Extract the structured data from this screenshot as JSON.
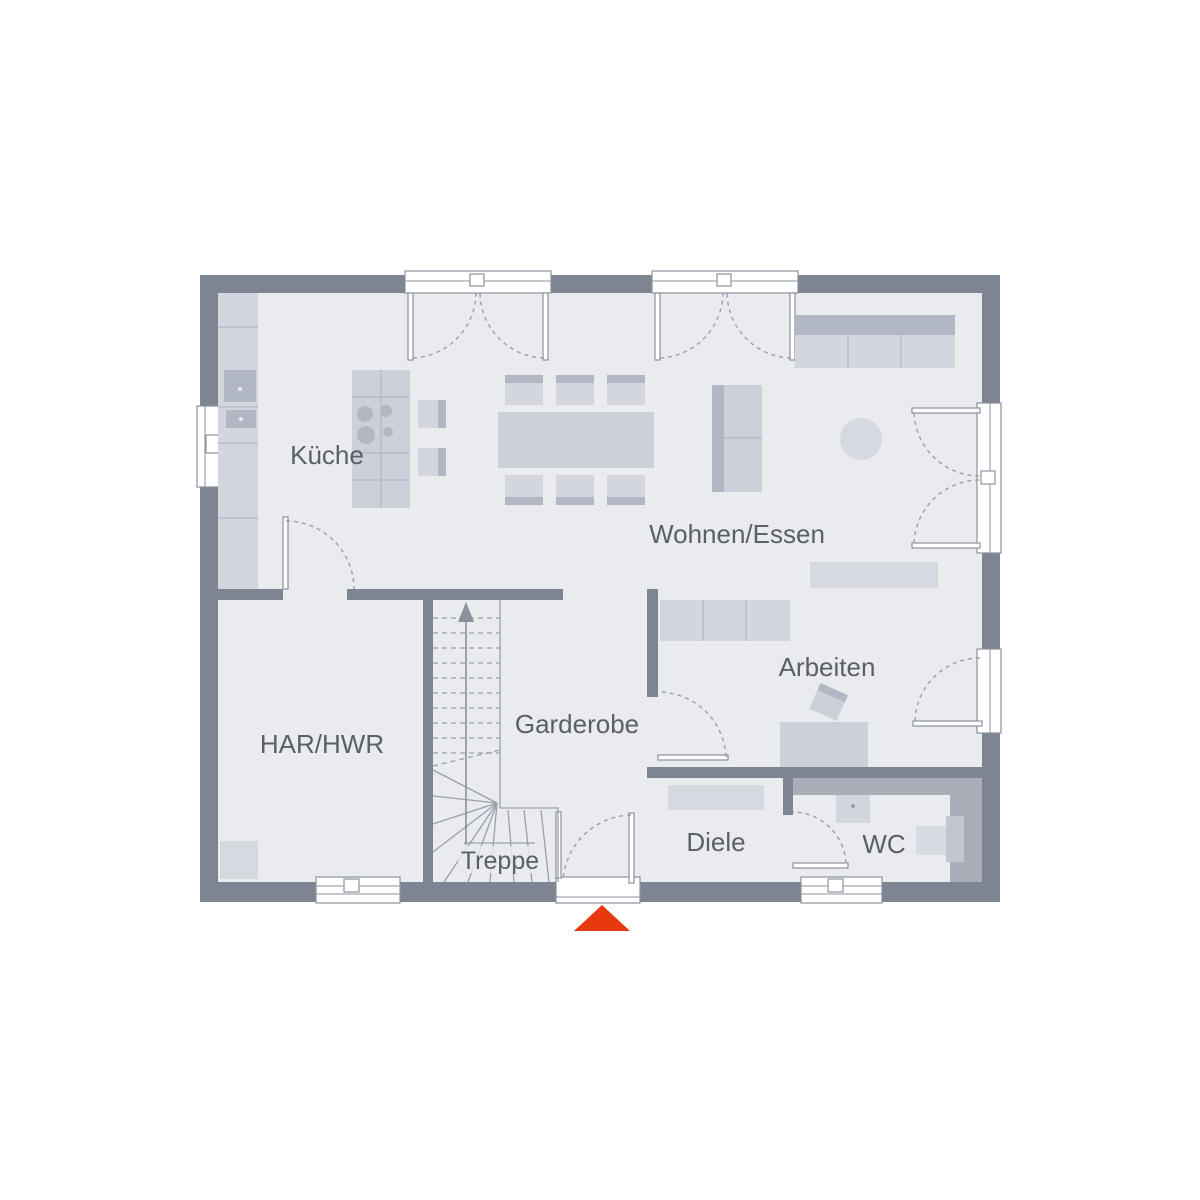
{
  "plan": {
    "type": "floor-plan",
    "rooms": {
      "kueche": {
        "label": "Küche"
      },
      "wohnen_essen": {
        "label": "Wohnen/Essen"
      },
      "har_hwr": {
        "label": "HAR/HWR"
      },
      "garderobe": {
        "label": "Garderobe"
      },
      "treppe": {
        "label": "Treppe"
      },
      "arbeiten": {
        "label": "Arbeiten"
      },
      "diele": {
        "label": "Diele"
      },
      "wc": {
        "label": "WC"
      }
    },
    "colors": {
      "wall": "#7d8492",
      "floor": "#e9ebef",
      "furniture_light": "#d3d6dd",
      "furniture_medium": "#b2b8c3",
      "installation_zone": "#a9aeb8",
      "outline": "#8b919c",
      "label_text": "#5a6066",
      "entrance_marker": "#e8380d"
    }
  }
}
